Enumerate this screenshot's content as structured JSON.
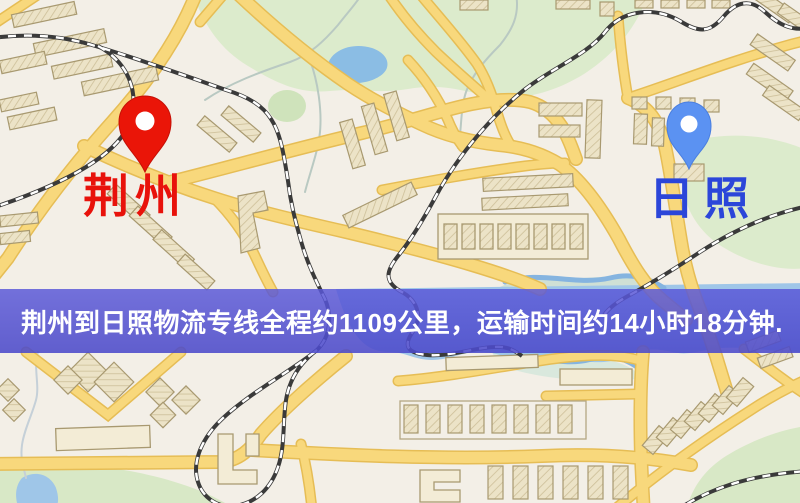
{
  "banner": {
    "text": "荆州到日照物流专线全程约1109公里，运输时间约14小时18分钟.",
    "background_color": "#5856d6",
    "text_color": "#ffffff"
  },
  "markers": {
    "origin": {
      "label": "荆州",
      "pin_color": "#ea1508",
      "label_color": "#e8120b"
    },
    "destination": {
      "label": "日照",
      "pin_color": "#5b92f2",
      "label_color": "#2b46d9"
    }
  },
  "route_info": {
    "distance_text": "约1109公里",
    "duration_text": "约14小时18分钟"
  },
  "map_palette": {
    "background": "#f3efe7",
    "road_fill": "#f8d87c",
    "road_casing": "#e6bd55",
    "water": "#9fc6e8",
    "park": "#dcebcc",
    "building": "#ece3c7",
    "railway": "#3a3a3a"
  }
}
